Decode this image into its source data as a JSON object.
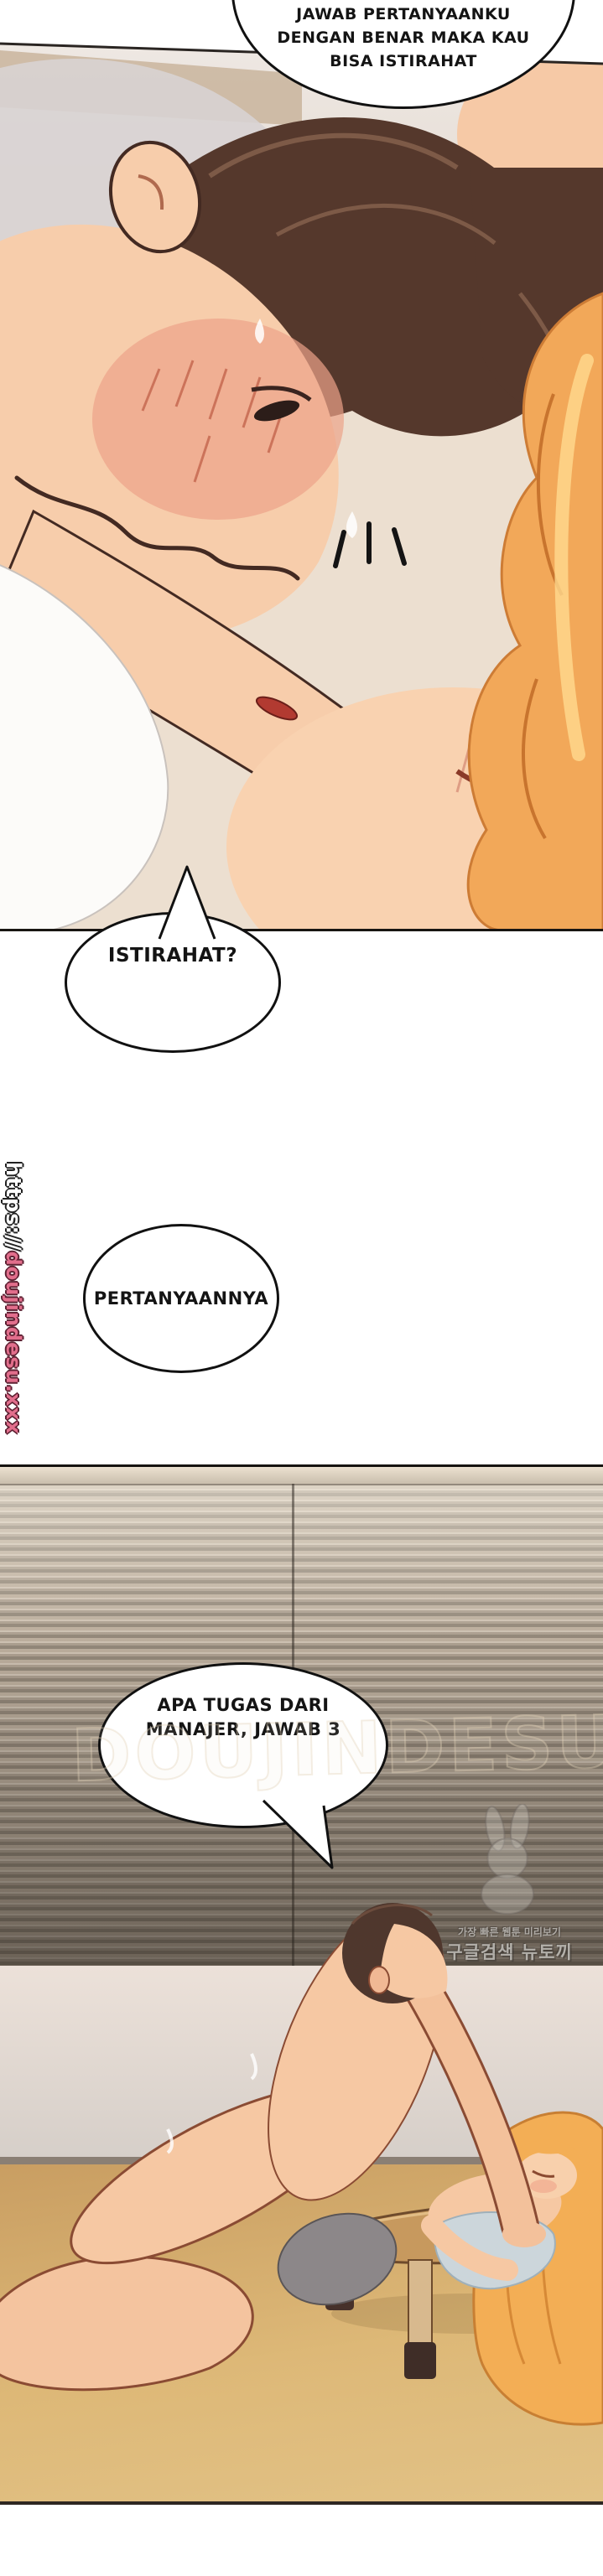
{
  "bubbles": {
    "question_top": {
      "lines": [
        "JAWAB PERTANYAANKU",
        "DENGAN BENAR MAKA KAU",
        "BISA ISTIRAHAT"
      ]
    },
    "istirahat": {
      "text": "ISTIRAHAT?"
    },
    "pertanyaannya": {
      "text": "PERTANYAANNYA"
    },
    "apa_tugas": {
      "lines": [
        "APA TUGAS DARI",
        "MANAJER, JAWAB 3"
      ]
    }
  },
  "watermarks": {
    "side_url": {
      "protocol": "https://",
      "site": "doujindesu.xxx"
    },
    "ghost": "DOUJINDESU",
    "newtoki": {
      "line1": "가장 빠른 웹툰 미리보기",
      "line2": "구글검색 뉴토끼",
      "icon": "rabbit-mascot"
    }
  },
  "colors": {
    "bubble_border": "#111111",
    "watermark_pink": "#e26e8c",
    "blinds_light": "#d6cabb",
    "blinds_dark": "#6f665e",
    "floor_wood": "#d9b06a",
    "hair_brown": "#55382c",
    "hair_orange": "#f2a859",
    "skin": "#f7cdab"
  }
}
